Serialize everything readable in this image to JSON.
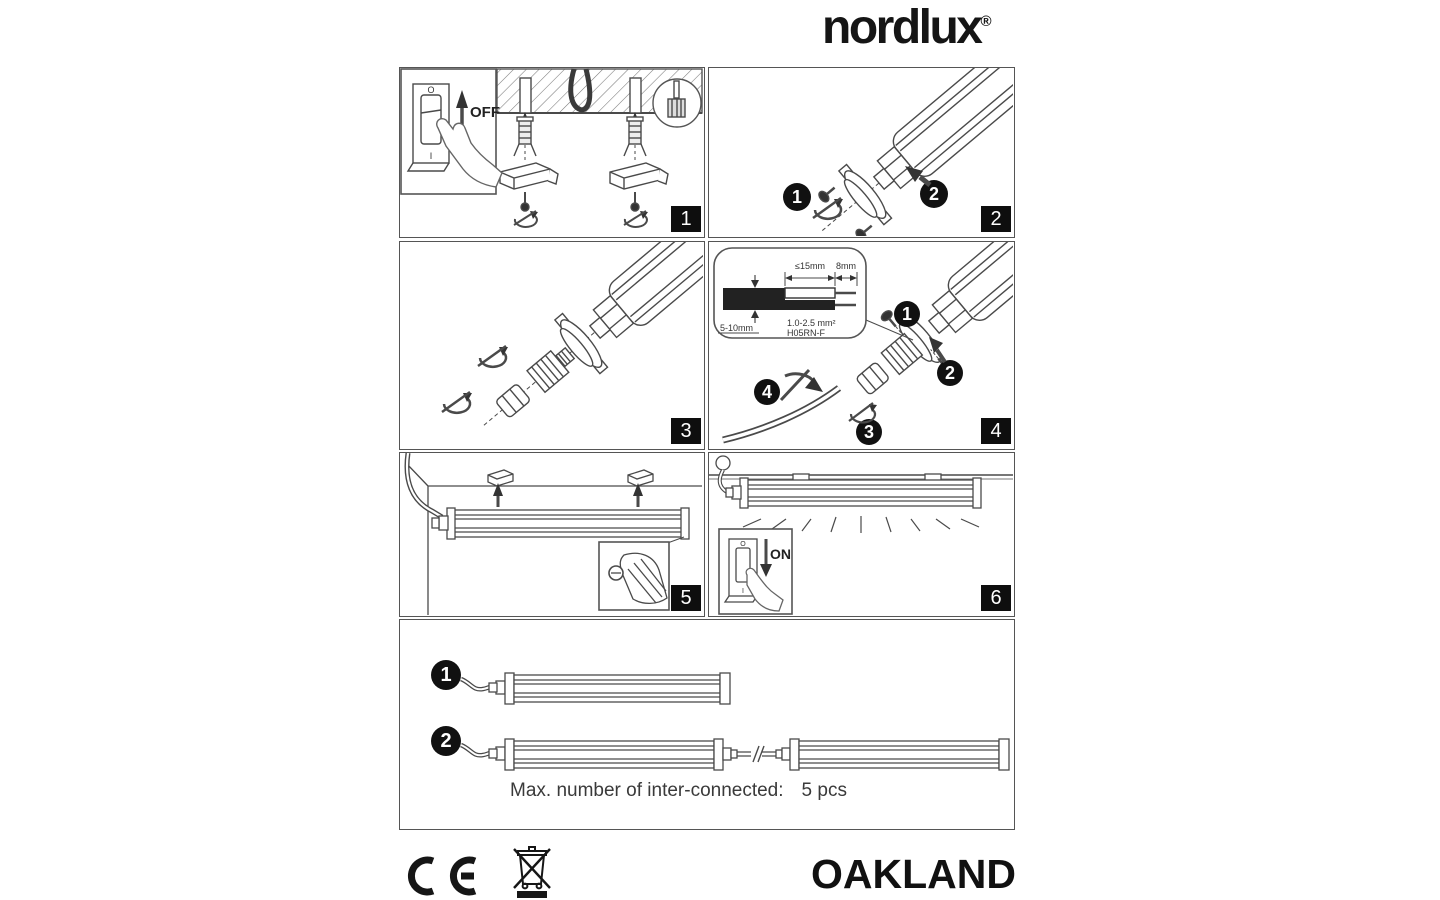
{
  "brand": {
    "name": "nordlux",
    "registered": "®"
  },
  "panels": {
    "p1": {
      "badge": "1",
      "switch_off_pos": "O",
      "switch_on_pos": "I",
      "action": "OFF"
    },
    "p2": {
      "badge": "2",
      "step1": "1",
      "step2": "2"
    },
    "p3": {
      "badge": "3"
    },
    "p4": {
      "badge": "4",
      "step1": "1",
      "step2": "2",
      "step3": "3",
      "step4": "4",
      "cable": {
        "outer_strip": "≤15mm",
        "inner_strip": "8mm",
        "diameter": "5-10mm",
        "cross_section": "1.0-2.5 mm²",
        "type": "H05RN-F"
      }
    },
    "p5": {
      "badge": "5"
    },
    "p6": {
      "badge": "6",
      "switch_off_pos": "O",
      "switch_on_pos": "I",
      "action": "ON"
    }
  },
  "interconnect": {
    "option1": "1",
    "option2": "2",
    "note_label": "Max. number of inter-connected:",
    "note_value": "5 pcs"
  },
  "footer": {
    "product": "OAKLAND"
  },
  "icons": {
    "ce": "ce-conformity-mark",
    "weee": "crossed-out-wheelie-bin",
    "hand": "pointing-hand",
    "hatch": "ceiling-hatch"
  },
  "colors": {
    "ink": "#4a4a4a",
    "badge_bg": "#0e0e0e",
    "paper": "#ffffff"
  }
}
